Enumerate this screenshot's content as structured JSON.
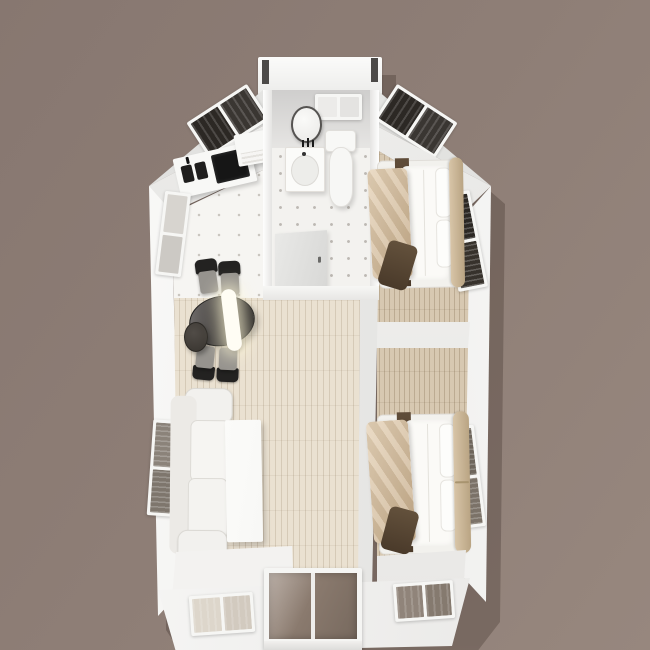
{
  "scene": {
    "title": "Top-down 3D render of a small home floor plan",
    "view": "bird's-eye interior render, roof cut away",
    "rooms": [
      "kitchen",
      "bathroom",
      "bedroom-top",
      "bedroom-bottom",
      "living-dining"
    ],
    "inventory": {
      "kitchen": [
        "counter-with-cooktop",
        "double-sink",
        "wall-shelf-unit",
        "roof-skylight"
      ],
      "bathroom": [
        "round-mirror",
        "vanity-sink",
        "toilet",
        "top-wall-window",
        "open-door"
      ],
      "bedroom_top": [
        "double-bed",
        "tan-blanket",
        "dark-throw",
        "headboard",
        "wall-window",
        "roof-skylight"
      ],
      "bedroom_bottom": [
        "double-bed",
        "tan-blanket",
        "dark-throw",
        "headboard",
        "wall-window",
        "eave-window"
      ],
      "living_dining": [
        "three-seat-sofa",
        "coffee-table",
        "oval-dining-table",
        "dining-chairs",
        "side-stool",
        "pendant-lamp",
        "entry-glass-door",
        "eave-window",
        "wall-windows"
      ]
    },
    "counts": {
      "beds": 2,
      "dining_chairs": 4,
      "skylights": 2,
      "wall_windows": 4,
      "eave_windows": 2
    }
  },
  "colors": {
    "bg-1": "#877770",
    "bg-mid": "#8e7e76",
    "bg-2": "#97877e",
    "wall": "#f6f6f4",
    "wall-dim": "#e7e6e4",
    "roof": "#e3e3e1",
    "tile": "#f6f5f2",
    "tile-dot": "#c9c5be",
    "bath-tile": "#f3f2ef",
    "bath-dot": "#bdb9b3",
    "wood": "#eae1d1",
    "wood-tan": "#d7c8b1",
    "glass-dark": "#2c2824",
    "glass-brown": "#8a7b6e",
    "blind-light": "#ddd6cb",
    "blind-brown": "#90847a",
    "blind-gray": "#8b837a",
    "duvet": "#fbfaf7",
    "blanket-1": "#e6d3b8",
    "blanket-2": "#c4aa88",
    "runner": "#57432f",
    "headboard-1": "#d8c5a8",
    "headboard-2": "#b9a483",
    "sofa": "#f2f1ee",
    "coffee": "#f8f8f6",
    "table-1": "#757170",
    "table-2": "#2d2b29",
    "chair": "#232221",
    "chair-seat": "#96938e",
    "stool-1": "#514c47",
    "stool-2": "#38342f",
    "cooktop": "#161616",
    "lamp": "#fffdf4",
    "door-glass-1": "#9c8c80",
    "door-glass-2": "#77695e",
    "post": "#4c4a48",
    "mirror-rim": "#555351",
    "shadow": "rgba(55,42,36,0.30)"
  }
}
